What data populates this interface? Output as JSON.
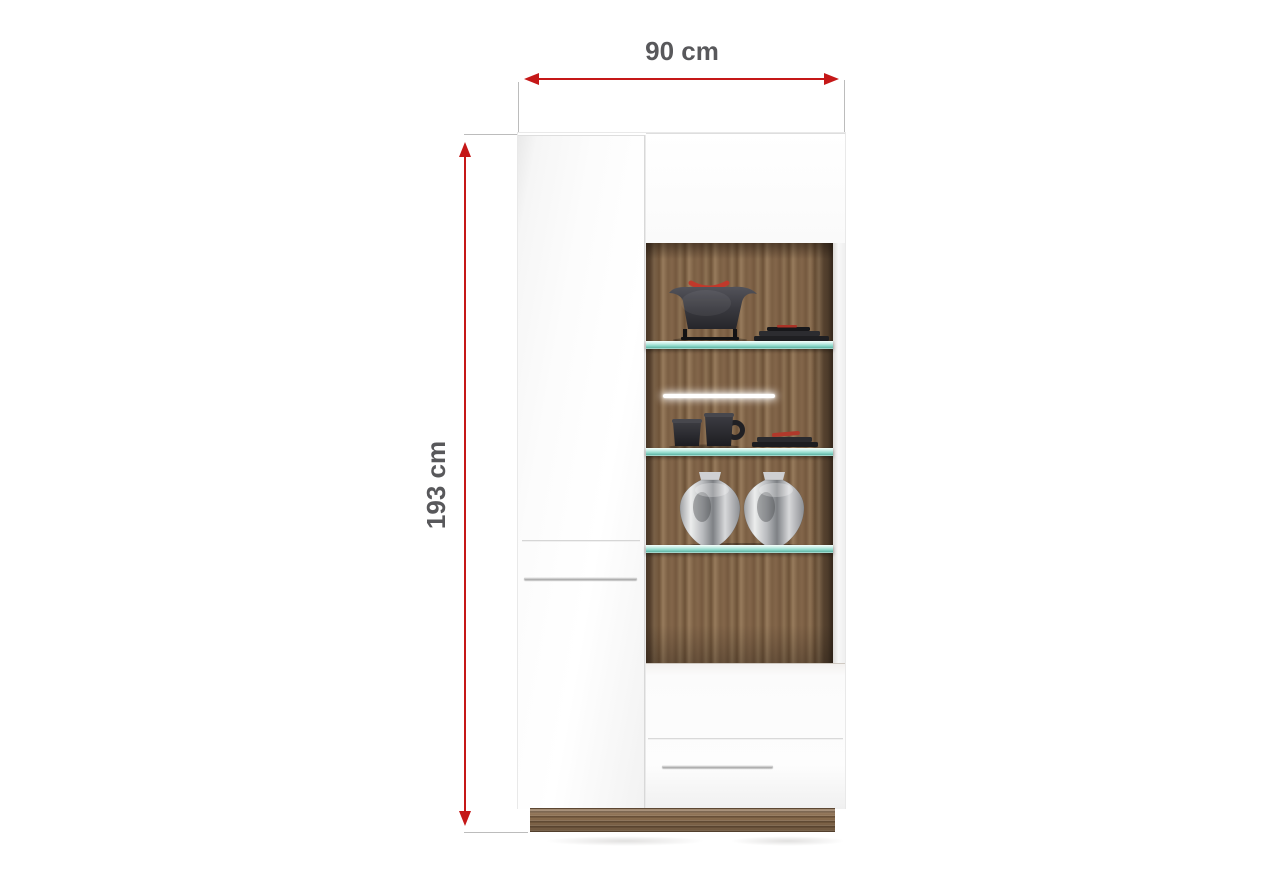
{
  "page": {
    "background": "#ffffff"
  },
  "dimension_annotations": {
    "width": {
      "label": "90 cm"
    },
    "height": {
      "label": "193 cm"
    },
    "arrow_color": "#c51818",
    "label_color": "#58585b",
    "extension_line_color": "#bcbcbc"
  },
  "cabinet": {
    "colors": {
      "body_white": "#fbfbfb",
      "seam_gray": "#d0d0d0",
      "handle_chrome": "#b9b9b9",
      "wood_light": "#977b5c",
      "wood_mid": "#7b5f44",
      "wood_dark": "#4f3c2c",
      "glass_shelf_teal": "#8fd9cb",
      "led_white": "#ffffff",
      "accent_red": "#b0392b"
    },
    "shelf_count": 3,
    "display_figures": [
      "teapot-with-red-handle",
      "stacked-dark-plates",
      "two-espresso-cups",
      "small-dark-plates-with-red-garnish",
      "two-silver-vases"
    ]
  }
}
